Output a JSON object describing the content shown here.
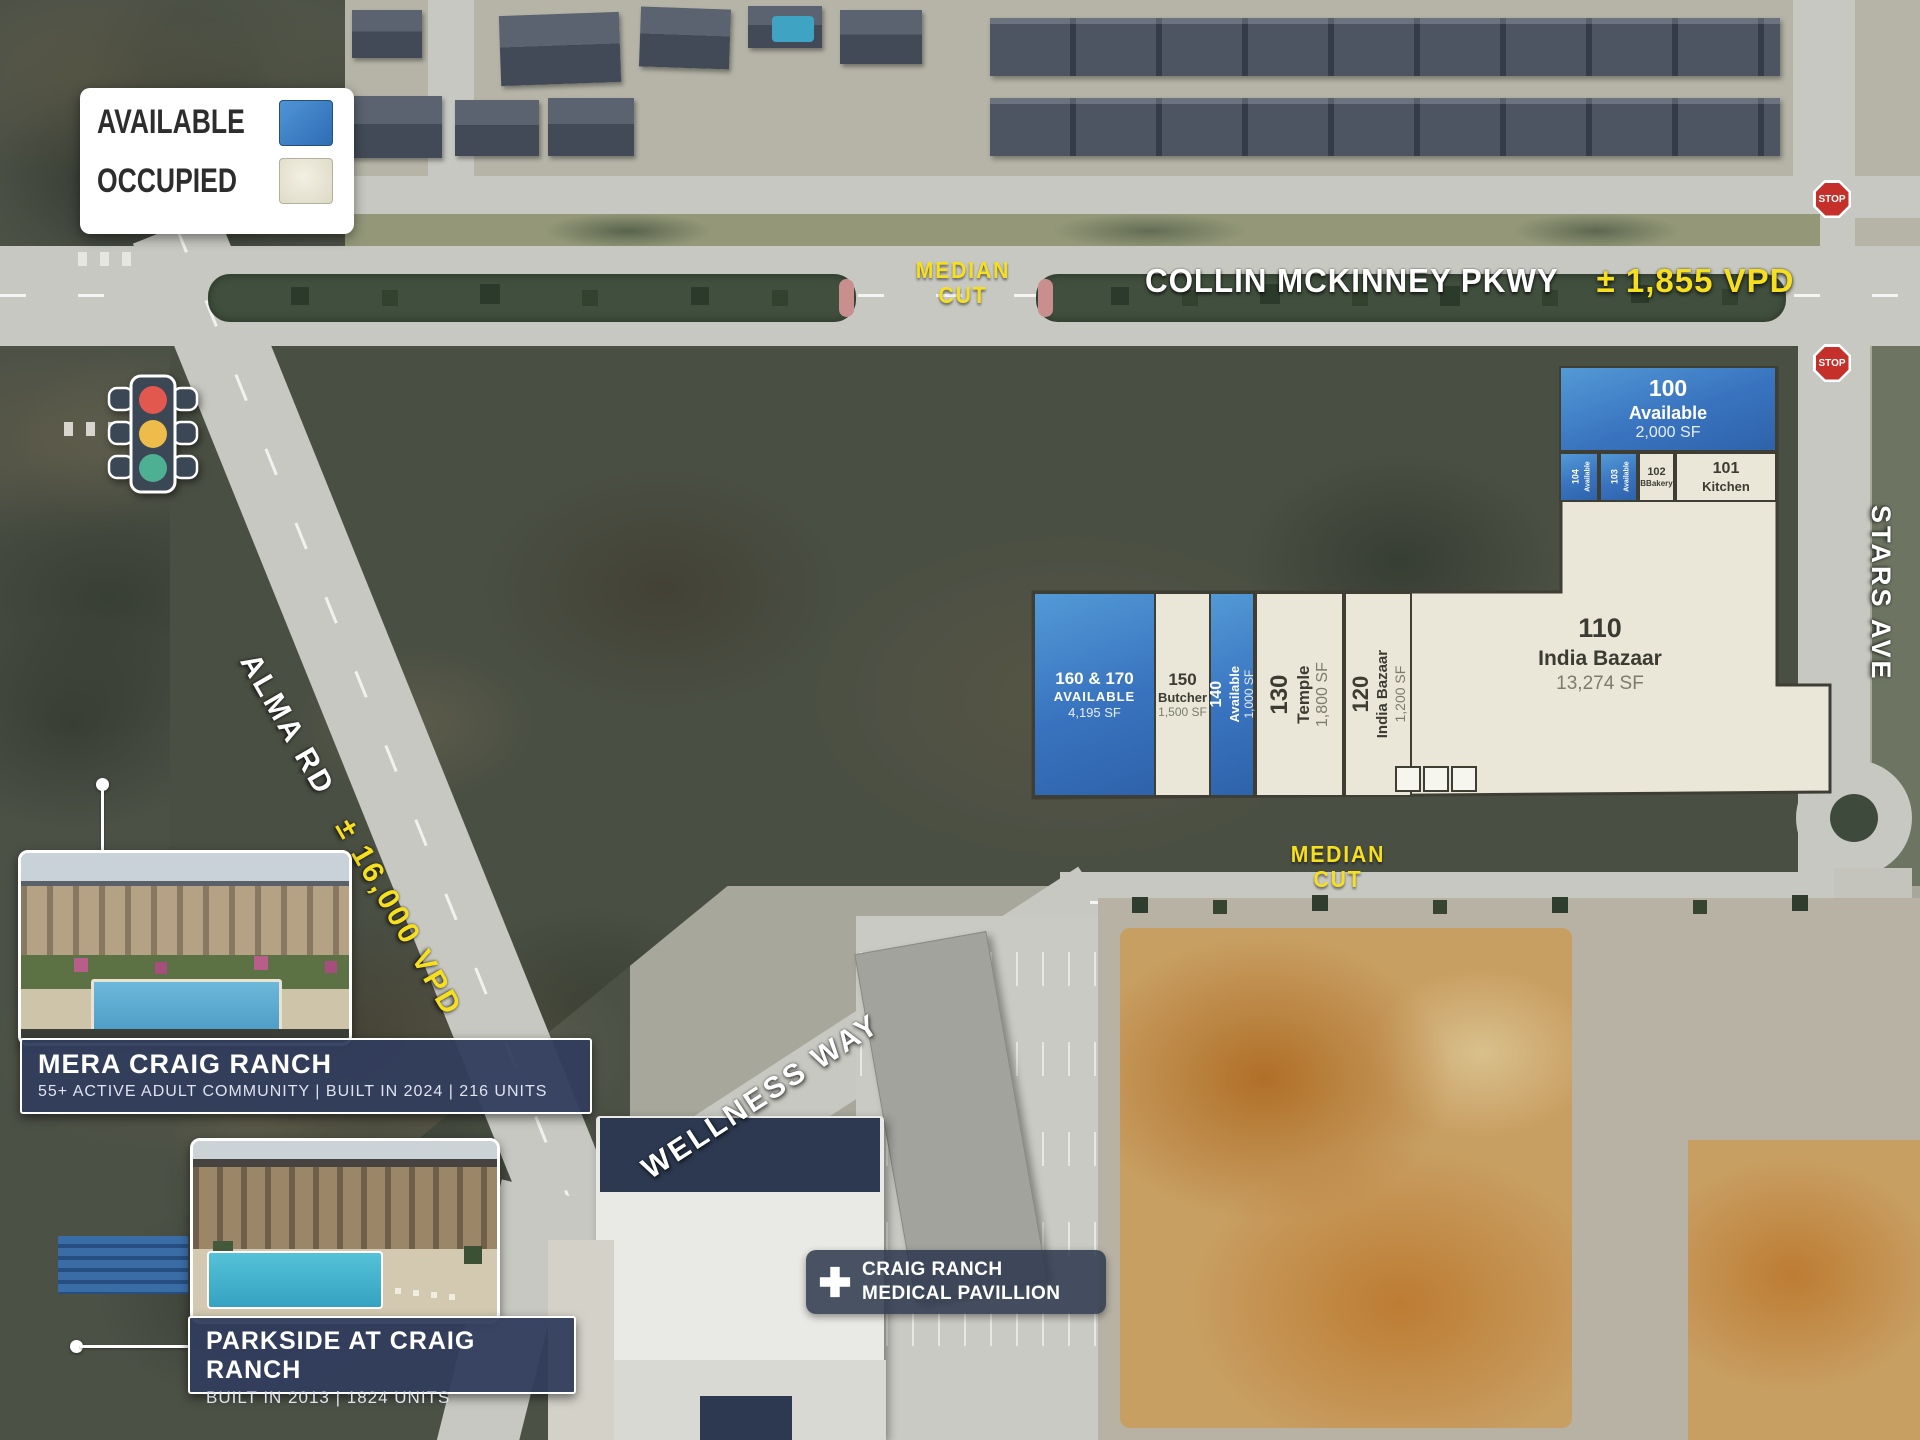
{
  "legend": {
    "available_label": "AVAILABLE",
    "occupied_label": "OCCUPIED"
  },
  "colors": {
    "available_blue": "#3b7dc8",
    "occupied_cream": "#eae7d8",
    "highlight_yellow": "#f6df1e",
    "callout_navy": "#313d5d",
    "stop_red": "#c5302a"
  },
  "roads": {
    "collin_mckinney": {
      "name": "COLLIN MCKINNEY PKWY",
      "vpd": "± 1,855 VPD"
    },
    "alma": {
      "name": "ALMA RD",
      "vpd": "± 16,000 VPD"
    },
    "wellness": {
      "name": "WELLNESS WAY"
    },
    "stars": {
      "name": "STARS AVE"
    },
    "median_cut_top": "MEDIAN CUT",
    "median_cut_bottom": "MEDIAN CUT",
    "stop": "STOP"
  },
  "suites": {
    "s100": {
      "number": "100",
      "name": "Available",
      "size": "2,000 SF"
    },
    "s101": {
      "number": "101",
      "name": "Kitchen"
    },
    "s102": {
      "number": "102",
      "name": "BBakery"
    },
    "s103": {
      "number": "103",
      "name": "Available"
    },
    "s104": {
      "number": "104",
      "name": "Available"
    },
    "s110": {
      "number": "110",
      "name": "India Bazaar",
      "size": "13,274 SF"
    },
    "s120": {
      "number": "120",
      "name": "India Bazaar",
      "size": "1,200 SF"
    },
    "s130": {
      "number": "130",
      "name": "Temple",
      "size": "1,800 SF"
    },
    "s140": {
      "number": "140",
      "name": "Available",
      "size": "1,000 SF"
    },
    "s150": {
      "number": "150",
      "name": "Butcher",
      "size": "1,500 SF"
    },
    "s160_170": {
      "number": "160 & 170",
      "name": "AVAILABLE",
      "size": "4,195 SF"
    }
  },
  "callouts": {
    "mera": {
      "title": "MERA CRAIG RANCH",
      "subtitle": "55+ ACTIVE ADULT COMMUNITY | BUILT IN 2024 | 216 UNITS"
    },
    "parkside": {
      "title": "PARKSIDE AT CRAIG RANCH",
      "subtitle": "BUILT IN 2013 | 1824 UNITS"
    },
    "medical": {
      "line1": "CRAIG RANCH",
      "line2": "MEDICAL PAVILLION"
    }
  }
}
